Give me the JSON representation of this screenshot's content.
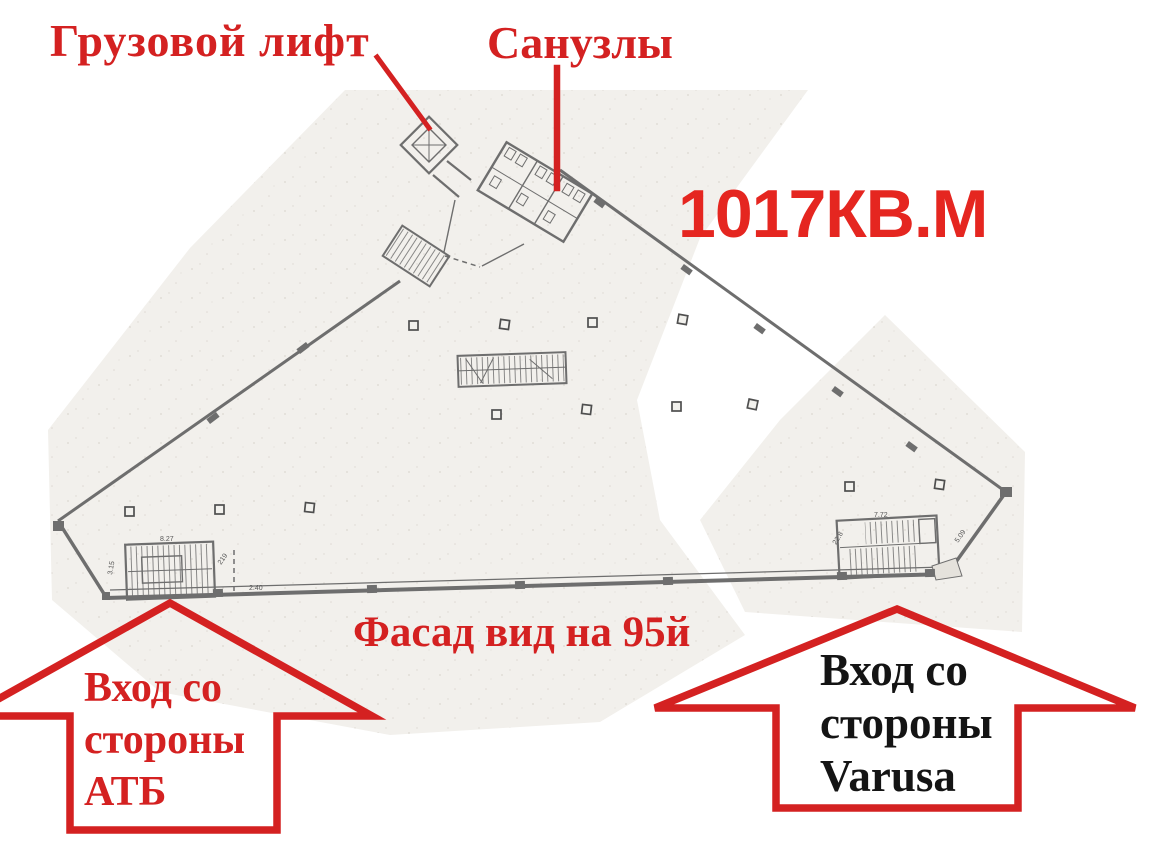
{
  "colors": {
    "annotation_red": "#d42121",
    "area_red": "#e52620",
    "entrance_right_text": "#141414",
    "wall_gray": "#6e6e6e",
    "scan_bg": "#f2f0ec"
  },
  "annotations": {
    "freight_elevator_label": "Грузовой лифт",
    "bathrooms_label": "Санузлы",
    "area_label": "1017КВ.М",
    "facade_label": "Фасад вид на 95й",
    "entrance_atb": {
      "lines": [
        "Вход со",
        "стороны",
        "АТБ"
      ]
    },
    "entrance_varusa": {
      "lines": [
        "Вход со",
        "стороны",
        "Varusa"
      ]
    }
  },
  "plan": {
    "dimension_marks": [
      {
        "text": "8.27"
      },
      {
        "text": "2.40"
      },
      {
        "text": "7.72"
      },
      {
        "text": "22.8"
      },
      {
        "text": "5.09"
      },
      {
        "text": "3.15"
      },
      {
        "text": "219"
      }
    ]
  }
}
